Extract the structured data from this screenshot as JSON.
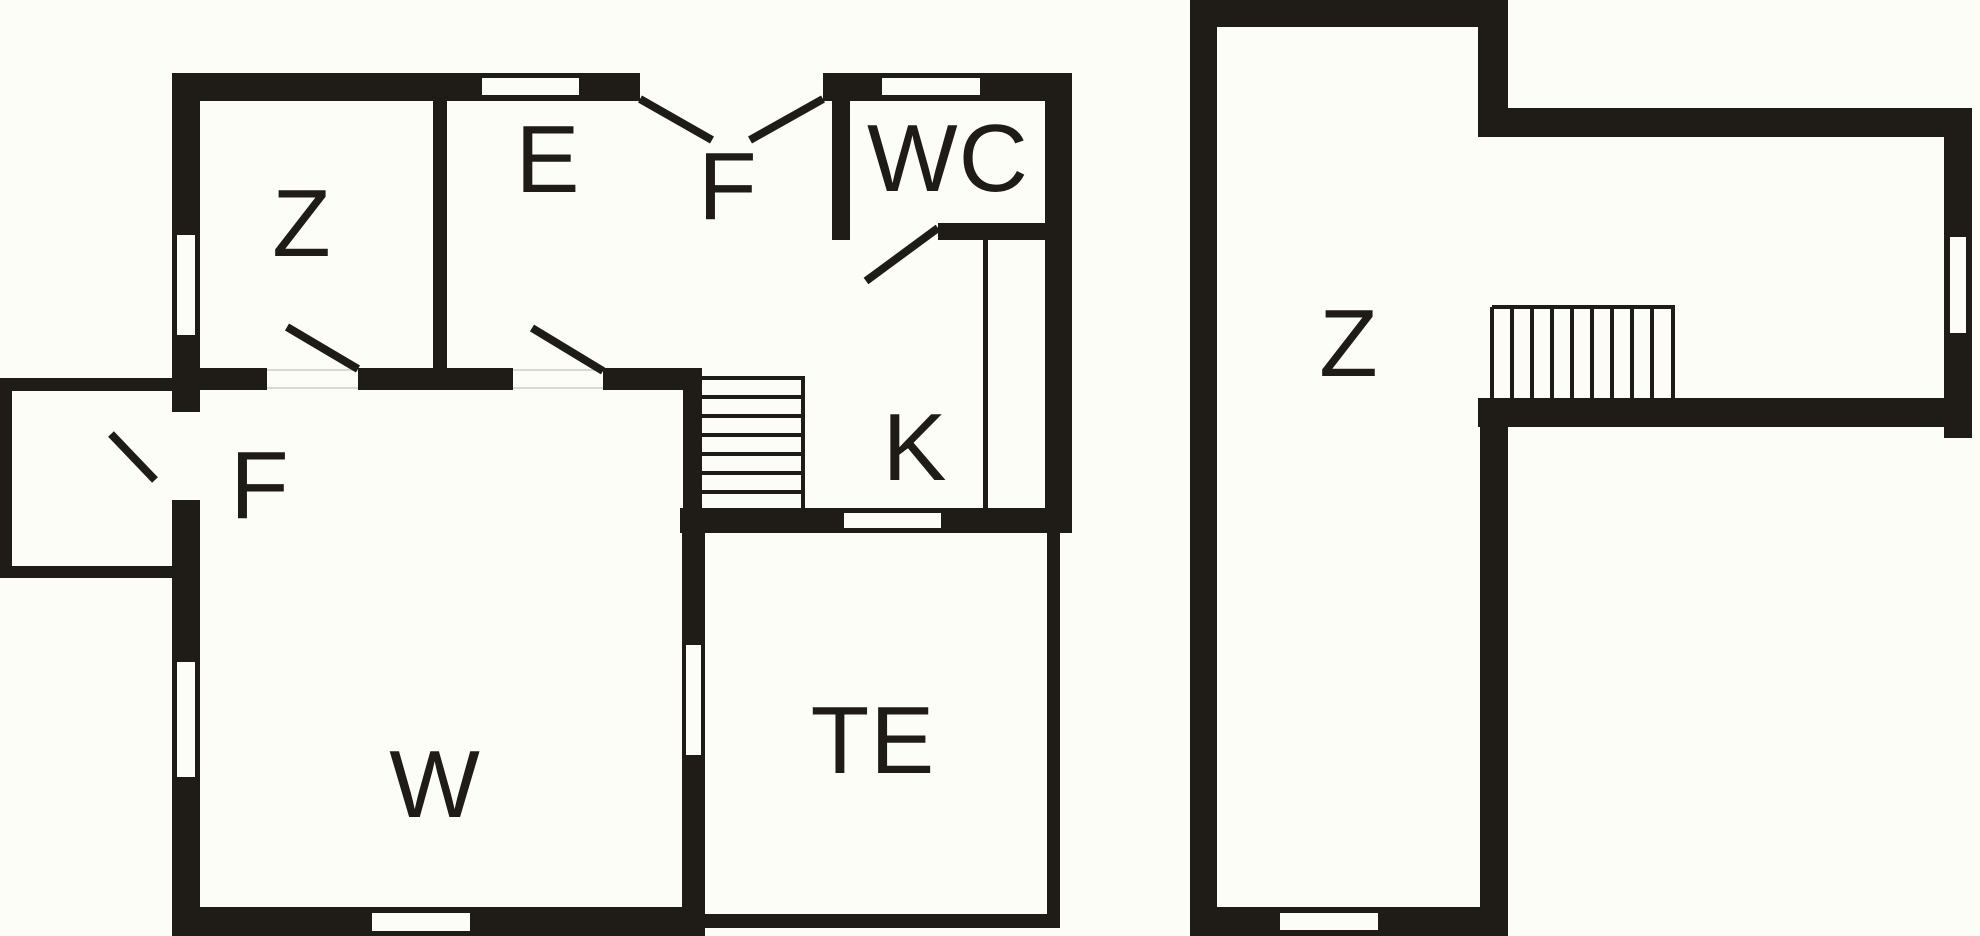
{
  "title": "floor-plan",
  "colors": {
    "wall": "#1f1c18",
    "paper": "#fdfdf7",
    "label": "#1f1c18",
    "gapline": "#d9d9d1"
  },
  "floors": [
    {
      "name": "ground-floor",
      "rooms": [
        {
          "id": "bedroom-z",
          "label": "Z",
          "cx": 302,
          "cy": 224
        },
        {
          "id": "room-e",
          "label": "E",
          "cx": 548,
          "cy": 160
        },
        {
          "id": "hall-f-top",
          "label": "F",
          "cx": 728,
          "cy": 187
        },
        {
          "id": "wc",
          "label": "WC",
          "cx": 948,
          "cy": 159
        },
        {
          "id": "kitchen-k",
          "label": "K",
          "cx": 915,
          "cy": 448
        },
        {
          "id": "hall-f-left",
          "label": "F",
          "cx": 260,
          "cy": 486
        },
        {
          "id": "living-w",
          "label": "W",
          "cx": 435,
          "cy": 785
        },
        {
          "id": "terrace-te",
          "label": "TE",
          "cx": 873,
          "cy": 741
        }
      ]
    },
    {
      "name": "upper-floor",
      "rooms": [
        {
          "id": "attic-z",
          "label": "Z",
          "cx": 1349,
          "cy": 344
        }
      ]
    }
  ],
  "geometry": {
    "walls": [
      {
        "x": 172,
        "y": 73,
        "w": 900,
        "h": 28
      },
      {
        "x": 172,
        "y": 73,
        "w": 28,
        "h": 863
      },
      {
        "x": 172,
        "y": 907,
        "w": 533,
        "h": 29
      },
      {
        "x": 1045,
        "y": 73,
        "w": 27,
        "h": 460
      },
      {
        "x": 433,
        "y": 101,
        "w": 14,
        "h": 289
      },
      {
        "x": 200,
        "y": 368,
        "w": 67,
        "h": 22
      },
      {
        "x": 358,
        "y": 368,
        "w": 155,
        "h": 22
      },
      {
        "x": 603,
        "y": 368,
        "w": 99,
        "h": 22
      },
      {
        "x": 683,
        "y": 368,
        "w": 19,
        "h": 140
      },
      {
        "x": 832,
        "y": 101,
        "w": 18,
        "h": 139
      },
      {
        "x": 938,
        "y": 223,
        "w": 109,
        "h": 17
      },
      {
        "x": 680,
        "y": 508,
        "w": 392,
        "h": 25
      },
      {
        "x": 682,
        "y": 533,
        "w": 23,
        "h": 374
      },
      {
        "x": 983,
        "y": 240,
        "w": 5,
        "h": 268
      },
      {
        "x": 0,
        "y": 378,
        "w": 172,
        "h": 13
      },
      {
        "x": 0,
        "y": 566,
        "w": 172,
        "h": 12
      },
      {
        "x": 0,
        "y": 378,
        "w": 12,
        "h": 200
      },
      {
        "x": 1047,
        "y": 533,
        "w": 13,
        "h": 395
      },
      {
        "x": 694,
        "y": 914,
        "w": 366,
        "h": 14
      },
      {
        "x": 1190,
        "y": 0,
        "w": 318,
        "h": 27
      },
      {
        "x": 1190,
        "y": 0,
        "w": 27,
        "h": 936
      },
      {
        "x": 1190,
        "y": 907,
        "w": 318,
        "h": 29
      },
      {
        "x": 1478,
        "y": 0,
        "w": 30,
        "h": 137
      },
      {
        "x": 1478,
        "y": 108,
        "w": 494,
        "h": 29
      },
      {
        "x": 1944,
        "y": 108,
        "w": 28,
        "h": 330
      },
      {
        "x": 1478,
        "y": 398,
        "w": 466,
        "h": 29
      },
      {
        "x": 1480,
        "y": 398,
        "w": 28,
        "h": 538
      }
    ],
    "windows": [
      {
        "x": 482,
        "y": 78,
        "w": 97,
        "h": 17
      },
      {
        "x": 882,
        "y": 78,
        "w": 98,
        "h": 17
      },
      {
        "x": 177,
        "y": 235,
        "w": 18,
        "h": 100
      },
      {
        "x": 177,
        "y": 662,
        "w": 18,
        "h": 115
      },
      {
        "x": 172,
        "y": 412,
        "w": 28,
        "h": 88
      },
      {
        "x": 372,
        "y": 913,
        "w": 98,
        "h": 18
      },
      {
        "x": 640,
        "y": 73,
        "w": 183,
        "h": 28
      },
      {
        "x": 850,
        "y": 223,
        "w": 88,
        "h": 17
      },
      {
        "x": 844,
        "y": 513,
        "w": 97,
        "h": 15
      },
      {
        "x": 686,
        "y": 645,
        "w": 15,
        "h": 110
      },
      {
        "x": 1280,
        "y": 913,
        "w": 98,
        "h": 17
      },
      {
        "x": 1950,
        "y": 237,
        "w": 16,
        "h": 96
      }
    ],
    "doors": [
      {
        "x1": 640,
        "y1": 99,
        "x2": 712,
        "y2": 140
      },
      {
        "x1": 823,
        "y1": 99,
        "x2": 750,
        "y2": 140
      },
      {
        "x1": 358,
        "y1": 369,
        "x2": 287,
        "y2": 327
      },
      {
        "x1": 603,
        "y1": 371,
        "x2": 532,
        "y2": 328
      },
      {
        "x1": 938,
        "y1": 228,
        "x2": 866,
        "y2": 281
      },
      {
        "x1": 155,
        "y1": 480,
        "x2": 111,
        "y2": 434
      }
    ],
    "stair_lines": [
      {
        "x1": 702,
        "y1": 378,
        "x2": 805,
        "y2": 378
      },
      {
        "x1": 702,
        "y1": 397,
        "x2": 805,
        "y2": 397
      },
      {
        "x1": 702,
        "y1": 416,
        "x2": 805,
        "y2": 416
      },
      {
        "x1": 702,
        "y1": 435,
        "x2": 805,
        "y2": 435
      },
      {
        "x1": 702,
        "y1": 454,
        "x2": 805,
        "y2": 454
      },
      {
        "x1": 702,
        "y1": 473,
        "x2": 805,
        "y2": 473
      },
      {
        "x1": 702,
        "y1": 492,
        "x2": 805,
        "y2": 492
      },
      {
        "x1": 803,
        "y1": 378,
        "x2": 803,
        "y2": 508
      },
      {
        "x1": 1492,
        "y1": 307,
        "x2": 1675,
        "y2": 307
      },
      {
        "x1": 1492,
        "y1": 307,
        "x2": 1492,
        "y2": 398
      },
      {
        "x1": 1512,
        "y1": 307,
        "x2": 1512,
        "y2": 398
      },
      {
        "x1": 1532,
        "y1": 307,
        "x2": 1532,
        "y2": 398
      },
      {
        "x1": 1552,
        "y1": 307,
        "x2": 1552,
        "y2": 398
      },
      {
        "x1": 1572,
        "y1": 307,
        "x2": 1572,
        "y2": 398
      },
      {
        "x1": 1592,
        "y1": 307,
        "x2": 1592,
        "y2": 398
      },
      {
        "x1": 1612,
        "y1": 307,
        "x2": 1612,
        "y2": 398
      },
      {
        "x1": 1632,
        "y1": 307,
        "x2": 1632,
        "y2": 398
      },
      {
        "x1": 1652,
        "y1": 307,
        "x2": 1652,
        "y2": 398
      },
      {
        "x1": 1673,
        "y1": 307,
        "x2": 1673,
        "y2": 398
      }
    ],
    "gap_lines": [
      {
        "x1": 267,
        "y1": 370,
        "x2": 358,
        "y2": 370
      },
      {
        "x1": 267,
        "y1": 388,
        "x2": 358,
        "y2": 388
      },
      {
        "x1": 513,
        "y1": 370,
        "x2": 603,
        "y2": 370
      },
      {
        "x1": 513,
        "y1": 388,
        "x2": 603,
        "y2": 388
      }
    ]
  }
}
